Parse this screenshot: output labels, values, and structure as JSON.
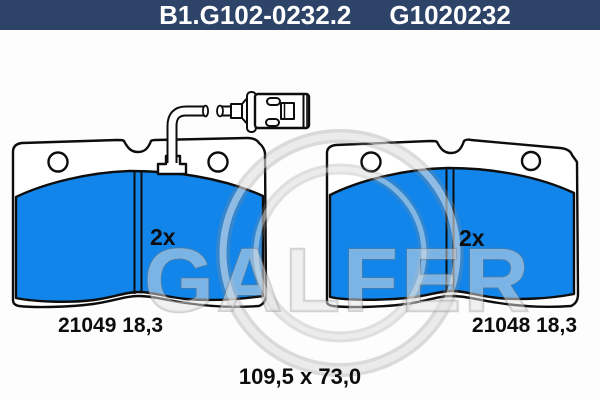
{
  "header": {
    "part_code": "B1.G102-0232.2",
    "oe_code": "G1020232"
  },
  "pads": {
    "left": {
      "label": "21049 18,3",
      "quantity": "2x"
    },
    "right": {
      "label": "21048 18,3",
      "quantity": "2x"
    }
  },
  "dimensions": "109,5 x 73,0",
  "watermark": "GALFER",
  "colors": {
    "header_bg": "#2d4468",
    "pad_fill": "#1185ea",
    "outline": "#0d0d0d"
  }
}
